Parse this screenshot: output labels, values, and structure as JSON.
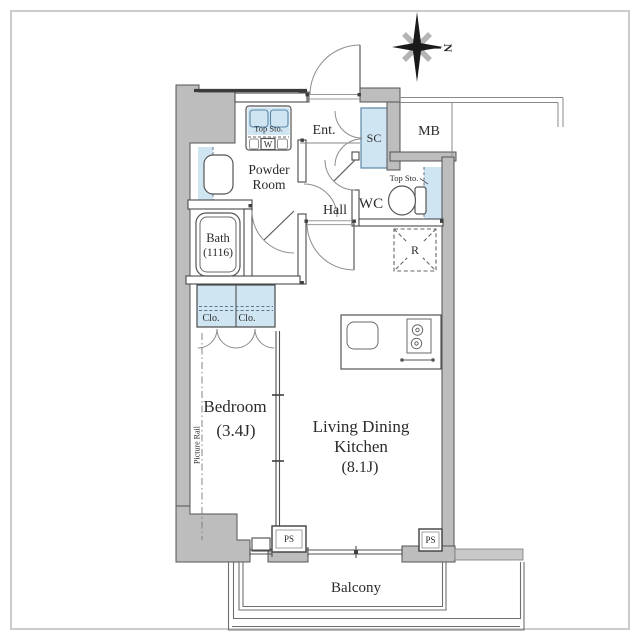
{
  "compass": {
    "north": "N"
  },
  "rooms": {
    "entrance": "Ent.",
    "shoe_closet": "SC",
    "meter_box": "MB",
    "powder_room": {
      "line1": "Powder",
      "line2": "Room"
    },
    "wc": "WC",
    "hall": "Hall",
    "bath": {
      "name": "Bath",
      "size": "(1116)"
    },
    "bedroom": {
      "name": "Bedroom",
      "size": "(3.4J)"
    },
    "ldk": {
      "line1": "Living Dining",
      "line2": "Kitchen",
      "size": "(8.1J)"
    },
    "balcony": "Balcony"
  },
  "features": {
    "washer_storage": "Top Sto.",
    "washer": "W",
    "wc_storage": "Top Sto.",
    "closet_left": "Clo.",
    "closet_right": "Clo.",
    "refrigerator": "R",
    "pipe_space_left": "PS",
    "pipe_space_right": "PS",
    "picture_rail": "Picture Rail"
  },
  "colors": {
    "wall_gray": "#bdbdbd",
    "fixture_blue": "#cfe5f2"
  }
}
